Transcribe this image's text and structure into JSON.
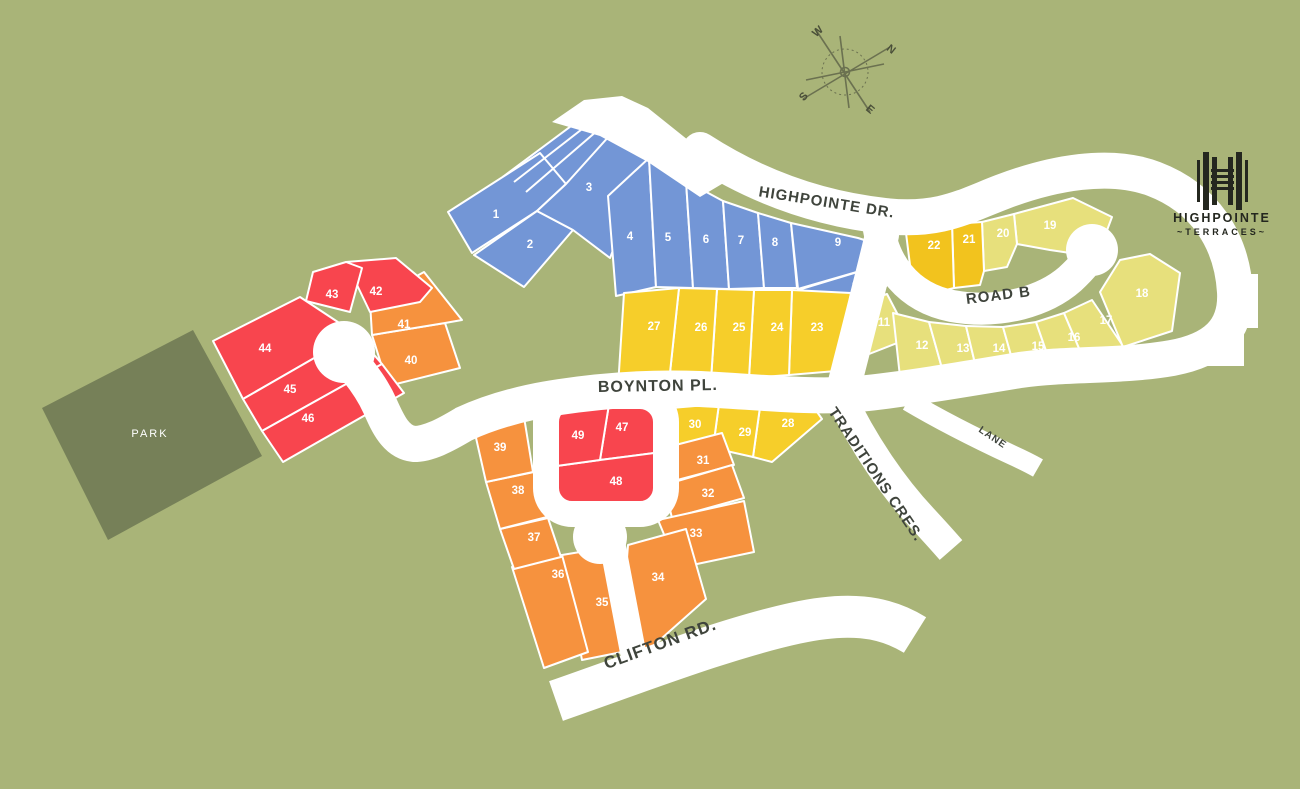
{
  "title": "Highpointe Terraces site plan",
  "colors": {
    "bg": "#A9B478",
    "park": "#768058",
    "road": "#FFFFFF",
    "blue": "#7396D6",
    "yellow": "#F6CE2A",
    "gold": "#F2C31E",
    "pale": "#E7E07C",
    "orange": "#F6923E",
    "red": "#F8454E",
    "label_dark": "#3F443C",
    "logo_dark": "#24271F",
    "compass_line": "#6B7150",
    "compass_letter": "#4A4F39"
  },
  "park": {
    "label": "PARK",
    "points": "193,330 262,456 108,540 42,408",
    "label_pos": [
      150,
      437
    ]
  },
  "strip": {
    "points": "504,176 598,106 622,126 566,184 540,208"
  },
  "strip_lines": [
    [
      514,
      182,
      604,
      112
    ],
    [
      526,
      192,
      612,
      118
    ]
  ],
  "entrance": {
    "points": "552,122 584,100 622,96 648,108 688,140 742,172 700,197 648,162 600,136"
  },
  "roads": [
    {
      "name": "highpointe-boynton-main",
      "d": "M 700,150 C 765,192 830,210 885,216 C 940,222 965,206 1002,192 C 1052,173 1110,162 1154,179 C 1204,198 1232,240 1235,292 C 1237,330 1215,350 1172,358 C 1120,367 1070,363 1020,370 C 960,380 900,390 858,394 C 810,398 760,392 700,389 C 650,387 600,391 560,397 C 520,403 490,412 464,424 C 444,436 428,444 414,444 C 396,442 388,424 380,406 C 372,388 358,370 346,357",
      "w": 36,
      "cap": "round"
    },
    {
      "name": "road-b",
      "d": "M 878,222 C 882,262 906,297 952,306 C 1002,315 1046,300 1070,279 C 1083,267 1090,258 1093,251",
      "w": 32,
      "cap": "round"
    },
    {
      "name": "connector",
      "d": "M 882,235 C 870,285 857,335 843,390",
      "w": 34,
      "cap": "round"
    },
    {
      "name": "south-court",
      "d": "M 612,542 L 633,652",
      "w": 26,
      "cap": "round"
    },
    {
      "name": "traditions-cres",
      "d": "M 841,397 C 864,445 893,487 923,519 C 936,533 944,542 951,550",
      "w": 30,
      "cap": "butt"
    },
    {
      "name": "lane",
      "d": "M 908,401 C 945,423 982,441 1012,455 C 1023,460 1031,464 1038,468",
      "w": 20,
      "cap": "butt"
    },
    {
      "name": "clifton-rd",
      "d": "M 556,701 C 642,671 727,638 796,623 C 846,612 883,615 915,635",
      "w": 42,
      "cap": "butt"
    }
  ],
  "ring": {
    "x": 546,
    "y": 396,
    "w": 120,
    "h": 118,
    "rx": 26,
    "stroke": 26
  },
  "culdesacs": [
    {
      "cx": 344,
      "cy": 352,
      "r": 31
    },
    {
      "cx": 1092,
      "cy": 250,
      "r": 26
    },
    {
      "cx": 600,
      "cy": 537,
      "r": 27
    }
  ],
  "stubs": [
    {
      "x": 1222,
      "y": 274,
      "w": 36,
      "h": 54
    },
    {
      "x": 1206,
      "y": 332,
      "w": 38,
      "h": 34
    }
  ],
  "lots": [
    {
      "value": "1",
      "group": "blue",
      "points": "448,212 540,153 566,184 537,211 472,253",
      "lx": 496,
      "ly": 218
    },
    {
      "value": "2",
      "group": "blue",
      "points": "474,255 537,211 573,230 524,287",
      "lx": 530,
      "ly": 248
    },
    {
      "value": "3",
      "group": "blue",
      "points": "537,211 566,184 620,124 655,143 610,258 573,230",
      "lx": 589,
      "ly": 191
    },
    {
      "value": "4",
      "group": "blue",
      "points": "608,196 649,158 656,287 616,296",
      "lx": 630,
      "ly": 240
    },
    {
      "value": "5",
      "group": "blue",
      "points": "649,158 686,181 693,288 656,287",
      "lx": 668,
      "ly": 241
    },
    {
      "value": "6",
      "group": "blue",
      "points": "686,181 723,201 729,289 693,288",
      "lx": 706,
      "ly": 243
    },
    {
      "value": "7",
      "group": "blue",
      "points": "723,201 758,213 764,288 729,289",
      "lx": 741,
      "ly": 244
    },
    {
      "value": "8",
      "group": "blue",
      "points": "758,213 791,223 797,288 764,288",
      "lx": 775,
      "ly": 246
    },
    {
      "value": "9",
      "group": "blue",
      "points": "791,223 858,238 886,247 874,267 798,289",
      "lx": 838,
      "ly": 246
    },
    {
      "value": "10",
      "group": "blue",
      "points": "798,290 874,267 890,280 858,330 815,309",
      "lx": 858,
      "ly": 290
    },
    {
      "value": "11",
      "group": "pale",
      "points": "851,306 887,294 910,338 864,356",
      "lx": 884,
      "ly": 326
    },
    {
      "value": "12",
      "group": "pale",
      "points": "893,313 929,322 945,379 901,386",
      "lx": 922,
      "ly": 349
    },
    {
      "value": "13",
      "group": "pale",
      "points": "929,322 966,326 978,376 945,379",
      "lx": 963,
      "ly": 352
    },
    {
      "value": "14",
      "group": "pale",
      "points": "966,326 1003,327 1016,373 978,376",
      "lx": 999,
      "ly": 352
    },
    {
      "value": "15",
      "group": "pale",
      "points": "1003,327 1036,322 1052,368 1016,373",
      "lx": 1038,
      "ly": 350
    },
    {
      "value": "16",
      "group": "pale",
      "points": "1036,322 1064,313 1084,360 1052,368",
      "lx": 1074,
      "ly": 341
    },
    {
      "value": "17",
      "group": "pale",
      "points": "1064,313 1092,300 1123,346 1084,360",
      "lx": 1106,
      "ly": 324
    },
    {
      "value": "18",
      "group": "pale",
      "points": "1100,292 1120,260 1150,254 1180,273 1172,331 1123,347",
      "lx": 1142,
      "ly": 297
    },
    {
      "value": "19",
      "group": "pale",
      "points": "1014,214 1073,198 1112,217 1097,257 1050,250 1017,244",
      "lx": 1050,
      "ly": 229
    },
    {
      "value": "20",
      "group": "pale",
      "points": "982,222 1014,214 1017,244 1007,267 984,271",
      "lx": 1003,
      "ly": 237
    },
    {
      "value": "21",
      "group": "gold",
      "points": "952,224 982,222 984,271 980,285 954,288",
      "lx": 969,
      "ly": 243
    },
    {
      "value": "22",
      "group": "gold",
      "points": "906,233 952,224 954,288 930,294 912,281",
      "lx": 934,
      "ly": 249
    },
    {
      "value": "23",
      "group": "yellow",
      "points": "792,290 851,293 836,371 789,375",
      "lx": 817,
      "ly": 331
    },
    {
      "value": "24",
      "group": "yellow",
      "points": "754,290 792,290 789,375 749,378",
      "lx": 777,
      "ly": 331
    },
    {
      "value": "25",
      "group": "yellow",
      "points": "717,289 754,290 749,378 711,380",
      "lx": 739,
      "ly": 331
    },
    {
      "value": "26",
      "group": "yellow",
      "points": "679,288 717,289 711,380 669,382",
      "lx": 701,
      "ly": 331
    },
    {
      "value": "27",
      "group": "yellow",
      "points": "624,293 679,288 669,382 618,387",
      "lx": 654,
      "ly": 330
    },
    {
      "value": "28",
      "group": "yellow",
      "points": "761,400 806,396 822,419 772,462 753,457",
      "lx": 788,
      "ly": 427
    },
    {
      "value": "29",
      "group": "yellow",
      "points": "719,404 761,400 753,457 713,448",
      "lx": 745,
      "ly": 436
    },
    {
      "value": "30",
      "group": "yellow",
      "points": "671,408 719,404 713,448 667,453",
      "lx": 695,
      "ly": 428
    },
    {
      "value": "31",
      "group": "orange",
      "points": "660,449 722,433 734,465 666,483",
      "lx": 703,
      "ly": 464
    },
    {
      "value": "32",
      "group": "orange",
      "points": "664,485 732,465 744,498 672,518",
      "lx": 708,
      "ly": 497
    },
    {
      "value": "33",
      "group": "orange",
      "points": "658,520 744,501 754,552 678,568",
      "lx": 696,
      "ly": 537
    },
    {
      "value": "34",
      "group": "orange",
      "points": "628,545 686,529 706,599 644,654 624,597",
      "lx": 658,
      "ly": 581
    },
    {
      "value": "35",
      "group": "orange",
      "points": "562,555 610,547 622,652 582,660",
      "lx": 602,
      "ly": 606
    },
    {
      "value": "36",
      "group": "orange",
      "points": "512,567 562,555 588,652 544,668",
      "lx": 558,
      "ly": 578
    },
    {
      "value": "37",
      "group": "orange",
      "points": "500,529 548,518 561,557 514,569",
      "lx": 534,
      "ly": 541
    },
    {
      "value": "38",
      "group": "orange",
      "points": "486,482 534,472 547,517 500,529",
      "lx": 518,
      "ly": 494
    },
    {
      "value": "39",
      "group": "orange",
      "points": "474,429 524,417 533,472 486,482",
      "lx": 500,
      "ly": 451
    },
    {
      "value": "40",
      "group": "orange",
      "points": "372,335 445,323 460,368 388,386",
      "lx": 411,
      "ly": 364
    },
    {
      "value": "41",
      "group": "orange",
      "points": "370,302 424,272 462,320 445,323 372,335",
      "lx": 404,
      "ly": 328
    },
    {
      "value": "42",
      "group": "red",
      "points": "346,262 396,258 432,288 420,302 370,312",
      "lx": 376,
      "ly": 295
    },
    {
      "value": "43",
      "group": "red",
      "points": "306,301 313,272 346,262 362,268 350,312",
      "lx": 332,
      "ly": 298
    },
    {
      "value": "44",
      "group": "red",
      "points": "213,341 300,297 356,334 243,399",
      "lx": 265,
      "ly": 352
    },
    {
      "value": "45",
      "group": "red",
      "points": "243,399 356,334 382,364 262,431",
      "lx": 290,
      "ly": 393
    },
    {
      "value": "46",
      "group": "red",
      "points": "262,431 382,364 404,393 283,462",
      "lx": 308,
      "ly": 422
    },
    {
      "value": "47",
      "group": "red",
      "points": "610,398 655,406 662,452 600,460",
      "lx": 622,
      "ly": 431
    },
    {
      "value": "48",
      "group": "red",
      "points": "542,468 600,460 662,452 650,516 568,522",
      "lx": 616,
      "ly": 485
    },
    {
      "value": "49",
      "group": "red",
      "points": "548,406 610,398 600,460 542,468",
      "lx": 578,
      "ly": 439
    }
  ],
  "road_labels": [
    {
      "text": "HIGHPOINTE DR.",
      "x": 826,
      "y": 207,
      "rot": 9,
      "size": 15,
      "spacing": 1
    },
    {
      "text": "ROAD B",
      "x": 999,
      "y": 300,
      "rot": -7,
      "size": 15,
      "spacing": 1
    },
    {
      "text": "BOYNTON PL.",
      "x": 658,
      "y": 391,
      "rot": -1,
      "size": 16,
      "spacing": 1
    },
    {
      "text": "TRADITIONS CRES.",
      "x": 872,
      "y": 477,
      "rot": 56,
      "size": 15,
      "spacing": 1
    },
    {
      "text": "LANE",
      "x": 991,
      "y": 440,
      "rot": 34,
      "size": 10,
      "spacing": 1
    },
    {
      "text": "CLIFTON RD.",
      "x": 662,
      "y": 649,
      "rot": -20,
      "size": 17,
      "spacing": 1
    }
  ],
  "compass": {
    "cx": 845,
    "cy": 72,
    "ring_r": 23,
    "hub_r": 4.5,
    "lines": [
      [
        816,
        30,
        870,
        112
      ],
      [
        890,
        47,
        803,
        99
      ],
      [
        840,
        36,
        849,
        108
      ],
      [
        806,
        80,
        884,
        64
      ]
    ],
    "letters": [
      {
        "t": "W",
        "x": 820,
        "y": 34,
        "rot": -42
      },
      {
        "t": "N",
        "x": 889,
        "y": 52,
        "rot": 38
      },
      {
        "t": "S",
        "x": 806,
        "y": 99,
        "rot": -46
      },
      {
        "t": "E",
        "x": 868,
        "y": 112,
        "rot": 40
      }
    ]
  },
  "logo": {
    "title": "HIGHPOINTE",
    "sub": "~TERRACES~",
    "cx": 1222,
    "bars_v": [
      [
        1197,
        160,
        3,
        42
      ],
      [
        1203,
        152,
        6,
        58
      ],
      [
        1212,
        157,
        5,
        48
      ],
      [
        1228,
        157,
        5,
        48
      ],
      [
        1236,
        152,
        6,
        58
      ],
      [
        1245,
        160,
        3,
        42
      ]
    ],
    "bars_h": [
      [
        1211,
        169,
        23,
        3
      ],
      [
        1211,
        175,
        23,
        3
      ],
      [
        1211,
        181,
        23,
        3
      ],
      [
        1211,
        187,
        23,
        3
      ]
    ]
  }
}
